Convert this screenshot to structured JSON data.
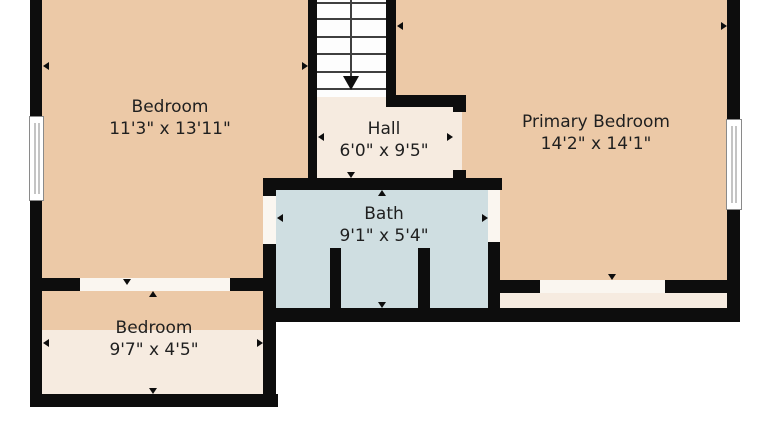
{
  "title": "Upper floor plan",
  "palette": {
    "wall": "#0d0d0d",
    "room_floor": "#ecc9a7",
    "low_ceiling_floor": "#f6ebe0",
    "bath_floor": "#cfdee1",
    "outside": "#ffffff",
    "text": "#1f1f1f"
  },
  "rooms": [
    {
      "id": "bedroom-upper",
      "name": "Bedroom",
      "dims": "11'3\" x 13'11\""
    },
    {
      "id": "hall",
      "name": "Hall",
      "dims": "6'0\" x 9'5\""
    },
    {
      "id": "primary-bedroom",
      "name": "Primary Bedroom",
      "dims": "14'2\" x 14'1\""
    },
    {
      "id": "bath",
      "name": "Bath",
      "dims": "9'1\" x 5'4\""
    },
    {
      "id": "bedroom-lower",
      "name": "Bedroom",
      "dims": "9'7\" x 4'5\""
    }
  ],
  "stairs": {
    "direction_marker": "down-arrow",
    "step_count": 6
  },
  "features": {
    "windows": [
      "left-exterior-wall",
      "right-exterior-wall"
    ],
    "door_openings": [
      "bath-left",
      "bath-right",
      "hall-to-primary",
      "bedroom-upper-to-lower",
      "primary-closet"
    ]
  }
}
